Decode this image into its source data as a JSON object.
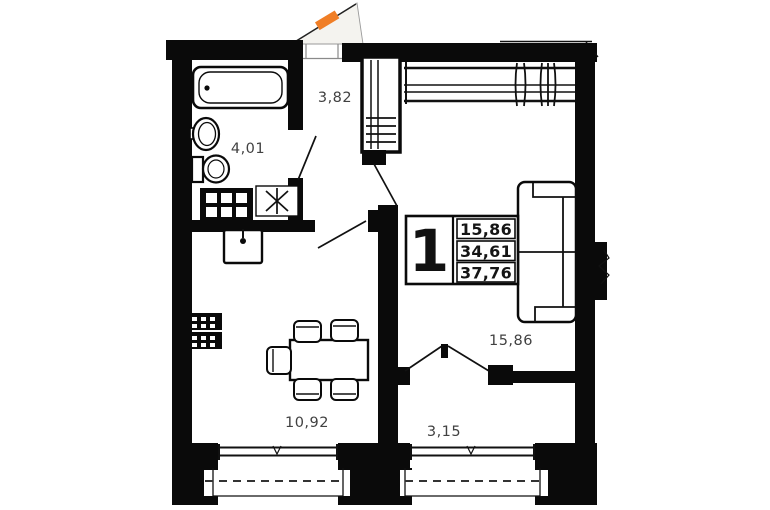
{
  "floor_plan": {
    "unit": {
      "number": "1",
      "areas": {
        "living": "15,86",
        "apartment": "34,61",
        "total": "37,76"
      }
    },
    "rooms": [
      {
        "name": "bathroom",
        "area": "4,01"
      },
      {
        "name": "hallway",
        "area": "3,82"
      },
      {
        "name": "kitchen",
        "area": "10,92"
      },
      {
        "name": "living-room",
        "area": "15,86"
      },
      {
        "name": "loggia",
        "area": "3,15"
      }
    ],
    "colors": {
      "walls": "#0a0a0a",
      "room_labels": "#414141",
      "entrance_marker": "#f07e26",
      "background": "#ffffff"
    }
  }
}
